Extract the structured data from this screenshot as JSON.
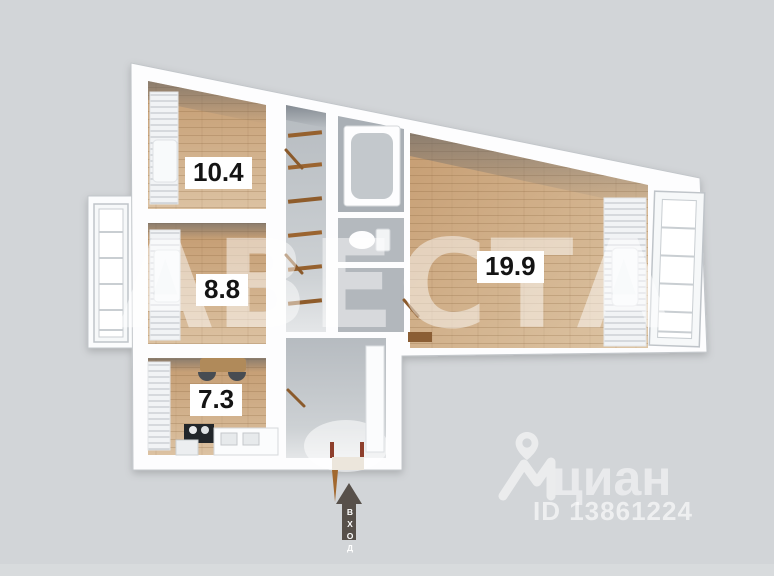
{
  "floorplan": {
    "rooms": [
      {
        "id": "room-top-left",
        "area": "10.4"
      },
      {
        "id": "room-middle-left",
        "area": "8.8"
      },
      {
        "id": "kitchen",
        "area": "7.3"
      },
      {
        "id": "living-room",
        "area": "19.9"
      }
    ],
    "entrance_label": "ВХОД"
  },
  "watermark": {
    "text": "АВЕСТА"
  },
  "branding": {
    "logo_text": "циан",
    "listing_id": "ID 13861224"
  },
  "colors": {
    "background": "#d2d5d8",
    "walls": "#fdfdfe",
    "wood_floor": "#cfae8c",
    "hall_floor": "#c6cacd",
    "entrance_arrow": "#57504a",
    "door_accent": "#a2682e"
  }
}
